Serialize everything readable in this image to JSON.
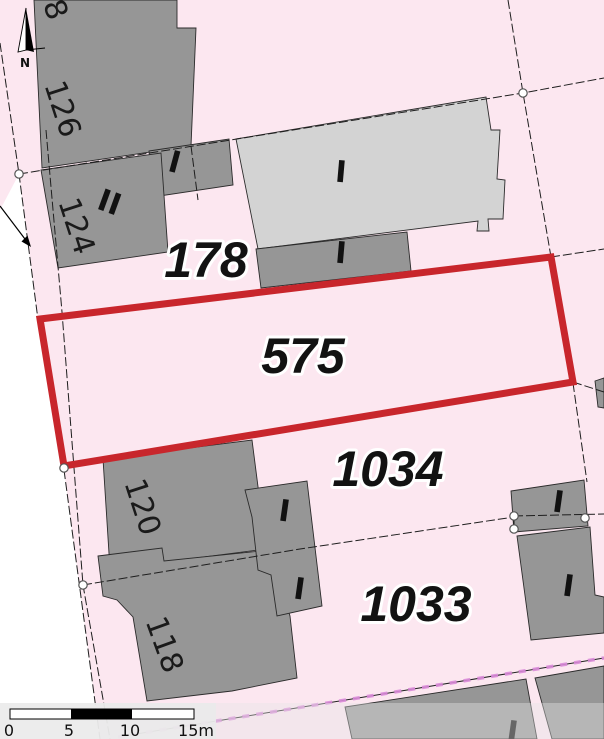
{
  "map": {
    "north_label": "N",
    "highlighted_parcel": {
      "number": "575"
    },
    "parcels": {
      "p178": "178",
      "p575": "575",
      "p1034": "1034",
      "p1033": "1033"
    },
    "house_numbers": {
      "h8": "8",
      "h126": "126",
      "h124": "124",
      "h120": "120",
      "h118": "118"
    },
    "storey_labels": {
      "building_126_annex": "I",
      "building_124": "II",
      "main_light_building": "I",
      "building_under_main": "I",
      "annex_column_upper": "I",
      "annex_column_lower": "I",
      "parcel_1033_building_upper": "I",
      "parcel_1033_building_lower": "I",
      "bottom_right_building": "I"
    },
    "scale_bar": {
      "tick_0": "0",
      "tick_5": "5",
      "tick_10": "10",
      "tick_15": "15m"
    },
    "colors": {
      "parcel_fill": "#fce7f0",
      "highlight_stroke": "#c8262c",
      "building_dark": "#969696",
      "building_light": "#d3d3d3",
      "boundary_line": "#1e1e1e",
      "municipal_boundary": "#d98ad8",
      "vertex_fill": "#ffffff"
    }
  }
}
